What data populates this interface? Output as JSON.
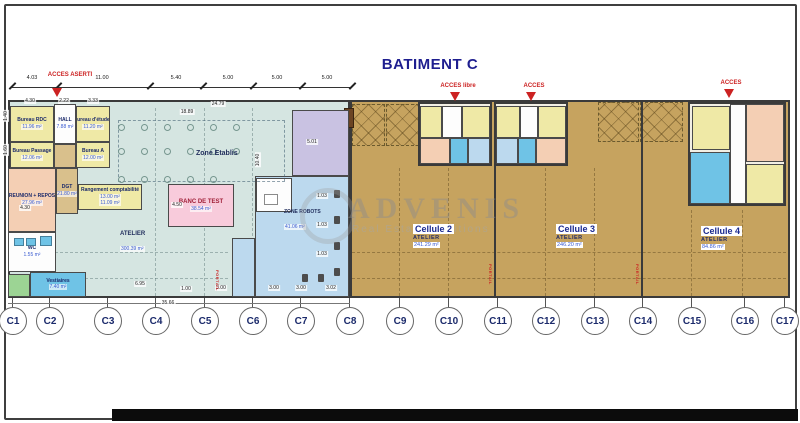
{
  "title": "BATIMENT C",
  "watermark": {
    "brand": "ADVENIS",
    "tagline": "Real Estate Solutions"
  },
  "colors": {
    "teal": "#d5e5e1",
    "tan": "#c6a35f",
    "tan2": "#d9c08c",
    "yellow": "#efe9a6",
    "white": "#fdfdfd",
    "salmon": "#f4cfb4",
    "pink": "#f8cbdb",
    "purple": "#c9c2e2",
    "robot_blue": "#bcd9ee",
    "vest_blue": "#6fc3e6",
    "green": "#9cd494",
    "navy": "#1e1e8f",
    "red": "#cc2222",
    "area_blue": "#3a5bd0",
    "wall": "#3a3a3a"
  },
  "top_dimension_labels": [
    {
      "text": "4.03",
      "x": 32
    },
    {
      "text": "11.00",
      "x": 102
    },
    {
      "text": "5.40",
      "x": 176
    },
    {
      "text": "5.00",
      "x": 228
    },
    {
      "text": "5.00",
      "x": 277
    },
    {
      "text": "5.00",
      "x": 327
    }
  ],
  "access_labels": [
    {
      "text": "ACCES ASERTI",
      "x": 70,
      "y": 72,
      "ax": 52,
      "ay": 88
    },
    {
      "text": "ACCES libre",
      "x": 458,
      "y": 83,
      "ax": 450,
      "ay": 92
    },
    {
      "text": "ACCES",
      "x": 534,
      "y": 83,
      "ax": 526,
      "ay": 92
    },
    {
      "text": "ACCES",
      "x": 731,
      "y": 80,
      "ax": 724,
      "ay": 89
    }
  ],
  "rooms": [
    {
      "name": "bureau-rdc",
      "label": "Bureau RDC",
      "area": "11.96 m²",
      "x": 10,
      "y": 106,
      "w": 44,
      "h": 36,
      "fill": "yellow"
    },
    {
      "name": "hall",
      "label": "HALL",
      "area": "7.88 m²",
      "x": 54,
      "y": 104,
      "w": 22,
      "h": 40,
      "fill": "white"
    },
    {
      "name": "bureau-etudes",
      "label": "Bureau d'études",
      "area": "11.20 m²",
      "x": 76,
      "y": 106,
      "w": 34,
      "h": 36,
      "fill": "yellow"
    },
    {
      "name": "bureau-passage",
      "label": "Bureau Passage",
      "area": "12.06 m²",
      "x": 10,
      "y": 142,
      "w": 44,
      "h": 26,
      "fill": "yellow"
    },
    {
      "name": "corridor",
      "label": "",
      "area": "",
      "x": 54,
      "y": 144,
      "w": 22,
      "h": 24,
      "fill": "tan2"
    },
    {
      "name": "bureau-a",
      "label": "Bureau A",
      "area": "12.00 m²",
      "x": 76,
      "y": 142,
      "w": 34,
      "h": 26,
      "fill": "yellow"
    },
    {
      "name": "reunion-repos",
      "label": "REUNION + REPOS",
      "area": "27.96 m²",
      "x": 8,
      "y": 168,
      "w": 48,
      "h": 64,
      "fill": "salmon"
    },
    {
      "name": "dgt",
      "label": "DGT",
      "area": "21.80 m²",
      "x": 56,
      "y": 168,
      "w": 22,
      "h": 46,
      "fill": "tan2"
    },
    {
      "name": "rangement-compta",
      "label": "Rangement comptabilité",
      "area": "13.00 m²",
      "area2": "11.09 m²",
      "x": 78,
      "y": 184,
      "w": 64,
      "h": 26,
      "fill": "yellow"
    },
    {
      "name": "wc",
      "label": "WC",
      "area": "1.55 m²",
      "x": 8,
      "y": 232,
      "w": 48,
      "h": 40,
      "fill": "white"
    },
    {
      "name": "local-vert",
      "label": "",
      "area": "",
      "x": 8,
      "y": 274,
      "w": 22,
      "h": 23,
      "fill": "green"
    },
    {
      "name": "vestiaires",
      "label": "Vestiaires",
      "area": "7.40 m²",
      "x": 30,
      "y": 272,
      "w": 56,
      "h": 25,
      "fill": "vest_blue"
    },
    {
      "name": "zone-purple",
      "label": "",
      "area": "",
      "x": 292,
      "y": 110,
      "w": 57,
      "h": 66,
      "fill": "purple"
    },
    {
      "name": "zone-robots-a",
      "label": "",
      "area": "",
      "x": 255,
      "y": 176,
      "w": 94,
      "h": 121,
      "fill": "robot_blue"
    },
    {
      "name": "zone-robots-b",
      "label": "",
      "area": "",
      "x": 232,
      "y": 238,
      "w": 23,
      "h": 59,
      "fill": "robot_blue"
    },
    {
      "name": "office-nook",
      "label": "",
      "area": "",
      "x": 256,
      "y": 178,
      "w": 36,
      "h": 34,
      "fill": "white"
    },
    {
      "name": "banc-de-test",
      "label": "BANC DE TEST",
      "area": "38.54 m²",
      "x": 168,
      "y": 184,
      "w": 66,
      "h": 43,
      "fill": "pink",
      "labelColor": "#a02038",
      "labelSize": 6
    },
    {
      "name": "c2-room-1",
      "label": "",
      "area": "",
      "x": 420,
      "y": 106,
      "w": 22,
      "h": 32,
      "fill": "yellow"
    },
    {
      "name": "c2-room-2",
      "label": "",
      "area": "",
      "x": 442,
      "y": 106,
      "w": 20,
      "h": 32,
      "fill": "white"
    },
    {
      "name": "c2-room-3",
      "label": "",
      "area": "",
      "x": 462,
      "y": 106,
      "w": 28,
      "h": 32,
      "fill": "yellow"
    },
    {
      "name": "c2-room-4",
      "label": "",
      "area": "",
      "x": 420,
      "y": 138,
      "w": 30,
      "h": 26,
      "fill": "salmon"
    },
    {
      "name": "c2-room-5",
      "label": "",
      "area": "",
      "x": 450,
      "y": 138,
      "w": 18,
      "h": 26,
      "fill": "vest_blue"
    },
    {
      "name": "c2-room-6",
      "label": "",
      "area": "",
      "x": 468,
      "y": 138,
      "w": 22,
      "h": 26,
      "fill": "robot_blue"
    },
    {
      "name": "c3-room-1",
      "label": "",
      "area": "",
      "x": 496,
      "y": 106,
      "w": 24,
      "h": 32,
      "fill": "yellow"
    },
    {
      "name": "c3-room-2",
      "label": "",
      "area": "",
      "x": 520,
      "y": 106,
      "w": 18,
      "h": 32,
      "fill": "white"
    },
    {
      "name": "c3-room-3",
      "label": "",
      "area": "",
      "x": 538,
      "y": 106,
      "w": 28,
      "h": 32,
      "fill": "yellow"
    },
    {
      "name": "c3-room-4",
      "label": "",
      "area": "",
      "x": 496,
      "y": 138,
      "w": 22,
      "h": 26,
      "fill": "robot_blue"
    },
    {
      "name": "c3-room-5",
      "label": "",
      "area": "",
      "x": 518,
      "y": 138,
      "w": 18,
      "h": 26,
      "fill": "vest_blue"
    },
    {
      "name": "c3-room-6",
      "label": "",
      "area": "",
      "x": 536,
      "y": 138,
      "w": 30,
      "h": 26,
      "fill": "salmon"
    },
    {
      "name": "c4-room-1",
      "label": "",
      "area": "",
      "x": 692,
      "y": 106,
      "w": 38,
      "h": 44,
      "fill": "yellow"
    },
    {
      "name": "c4-corridor",
      "label": "",
      "area": "",
      "x": 730,
      "y": 104,
      "w": 16,
      "h": 100,
      "fill": "white"
    },
    {
      "name": "c4-room-2",
      "label": "",
      "area": "",
      "x": 746,
      "y": 104,
      "w": 38,
      "h": 58,
      "fill": "salmon"
    },
    {
      "name": "c4-room-3",
      "label": "",
      "area": "",
      "x": 690,
      "y": 152,
      "w": 40,
      "h": 52,
      "fill": "vest_blue"
    },
    {
      "name": "c4-room-4",
      "label": "",
      "area": "",
      "x": 746,
      "y": 164,
      "w": 38,
      "h": 40,
      "fill": "yellow"
    }
  ],
  "zone_labels": [
    {
      "name": "zone-etablis",
      "label": "Zone Etablis",
      "area": "",
      "x": 196,
      "y": 150,
      "size": 7
    },
    {
      "name": "atelier-main",
      "label": "ATELIER",
      "area": "300.39 m²",
      "x": 120,
      "y": 231,
      "size": 6
    },
    {
      "name": "zone-robots",
      "label": "ZONE ROBOTS",
      "area": "41.06 m²",
      "x": 284,
      "y": 209,
      "size": 5
    }
  ],
  "cells": [
    {
      "name": "cellule-2",
      "label": "Cellule 2",
      "type": "ATELIER",
      "area": "241.29 m²",
      "x": 413,
      "y": 224
    },
    {
      "name": "cellule-3",
      "label": "Cellule 3",
      "type": "ATELIER",
      "area": "246.20 m²",
      "x": 556,
      "y": 224
    },
    {
      "name": "cellule-4",
      "label": "Cellule 4",
      "type": "ATELIER",
      "area": "84.86 m²",
      "x": 701,
      "y": 226
    }
  ],
  "small_dimensions": [
    {
      "text": "4.30",
      "x": 30,
      "y": 101
    },
    {
      "text": "2.22",
      "x": 64,
      "y": 101
    },
    {
      "text": "3.33",
      "x": 93,
      "y": 101
    },
    {
      "text": "24.79",
      "x": 218,
      "y": 104
    },
    {
      "text": "18.89",
      "x": 187,
      "y": 112
    },
    {
      "text": "10.40",
      "x": 258,
      "y": 160,
      "rot": true
    },
    {
      "text": "5.01",
      "x": 312,
      "y": 142
    },
    {
      "text": "1.40",
      "x": 6,
      "y": 116,
      "rot": true
    },
    {
      "text": "1.60",
      "x": 6,
      "y": 150,
      "rot": true
    },
    {
      "text": "4.30",
      "x": 25,
      "y": 208
    },
    {
      "text": "4.50",
      "x": 177,
      "y": 205
    },
    {
      "text": "6.95",
      "x": 140,
      "y": 284
    },
    {
      "text": "1.00",
      "x": 186,
      "y": 289
    },
    {
      "text": "3.00",
      "x": 221,
      "y": 288
    },
    {
      "text": "3.00",
      "x": 274,
      "y": 288
    },
    {
      "text": "3.00",
      "x": 301,
      "y": 288
    },
    {
      "text": "3.02",
      "x": 331,
      "y": 288
    },
    {
      "text": "1.03",
      "x": 322,
      "y": 196
    },
    {
      "text": "1.03",
      "x": 322,
      "y": 225
    },
    {
      "text": "1.03",
      "x": 322,
      "y": 254
    },
    {
      "text": "35.66",
      "x": 168,
      "y": 303
    }
  ],
  "grid_columns": [
    {
      "label": "C1",
      "x": 12
    },
    {
      "label": "C2",
      "x": 49
    },
    {
      "label": "C3",
      "x": 107
    },
    {
      "label": "C4",
      "x": 155
    },
    {
      "label": "C5",
      "x": 204
    },
    {
      "label": "C6",
      "x": 252
    },
    {
      "label": "C7",
      "x": 300
    },
    {
      "label": "C8",
      "x": 349
    },
    {
      "label": "C9",
      "x": 399
    },
    {
      "label": "C10",
      "x": 448
    },
    {
      "label": "C11",
      "x": 497
    },
    {
      "label": "C12",
      "x": 545
    },
    {
      "label": "C13",
      "x": 594
    },
    {
      "label": "C14",
      "x": 642
    },
    {
      "label": "C15",
      "x": 691
    },
    {
      "label": "C16",
      "x": 744
    },
    {
      "label": "C17",
      "x": 784
    }
  ],
  "portail_labels": [
    {
      "text": "PORTAIL",
      "x": 215,
      "y": 270
    },
    {
      "text": "PORTAIL",
      "x": 488,
      "y": 264
    },
    {
      "text": "PORTAIL",
      "x": 635,
      "y": 264
    }
  ]
}
